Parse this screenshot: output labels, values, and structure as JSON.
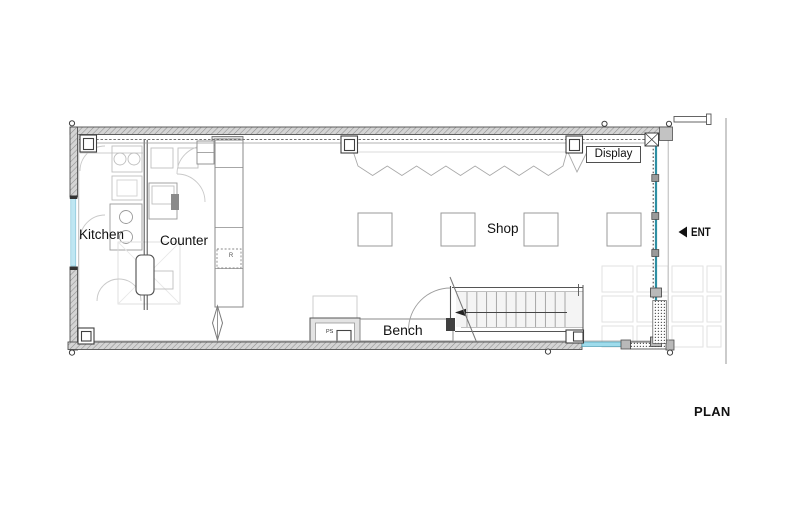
{
  "sheet": {
    "title": "PLAN"
  },
  "rooms": {
    "kitchen": {
      "label": "Kitchen"
    },
    "counter": {
      "label": "Counter"
    },
    "shop": {
      "label": "Shop"
    }
  },
  "fixtures": {
    "bench": {
      "label": "Bench"
    },
    "display": {
      "label": "Display"
    },
    "pipe_shaft": {
      "label": "PS"
    },
    "refrigerator": {
      "label": "R"
    }
  },
  "entrance": {
    "label": "ENT",
    "icon": "left-arrow"
  },
  "drawing": {
    "shop_table_count": 4,
    "stair_tread_count": 11,
    "colors": {
      "wall_hatch": "#cfcfcf",
      "ink": "#3f3f3f",
      "glazing_light": "#9fdcec",
      "glazing_teal": "#2e8fa3",
      "faint_line": "#c9c9c9"
    }
  }
}
